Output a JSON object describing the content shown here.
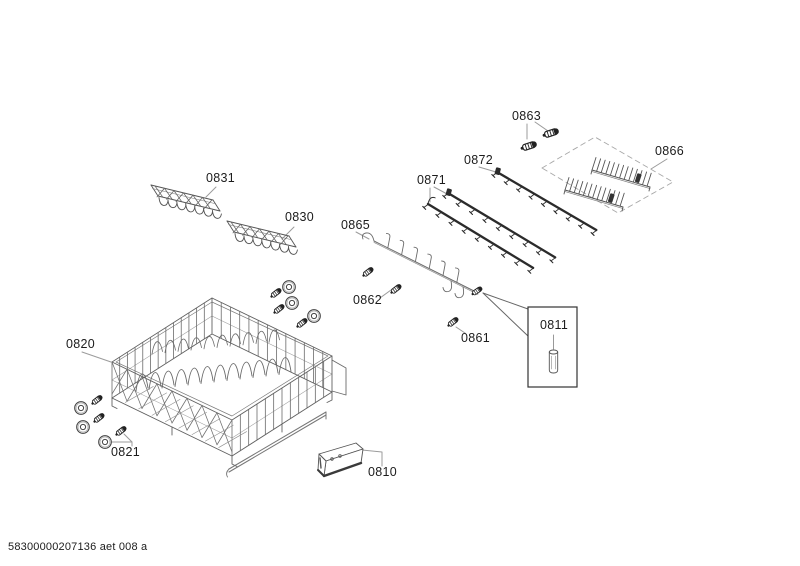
{
  "diagram": {
    "title": "exploded-parts-diagram",
    "footer_text": "58300000207136 aet 008 a",
    "part_labels": {
      "p0810": "0810",
      "p0811": "0811",
      "p0820": "0820",
      "p0821": "0821",
      "p0830": "0830",
      "p0831": "0831",
      "p0861": "0861",
      "p0862": "0862",
      "p0863": "0863",
      "p0865": "0865",
      "p0866": "0866",
      "p0871": "0871",
      "p0872": "0872"
    }
  }
}
